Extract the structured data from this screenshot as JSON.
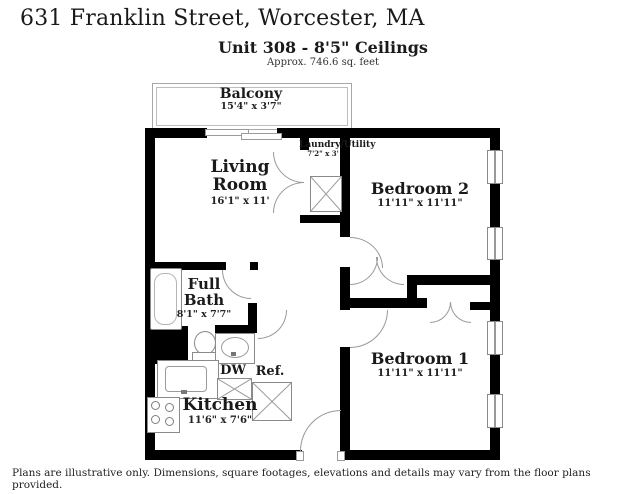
{
  "header": {
    "address": "631 Franklin Street, Worcester, MA",
    "unit_title": "Unit 308 - 8'5\" Ceilings",
    "unit_subtitle": "Approx. 746.6 sq. feet"
  },
  "rooms": {
    "balcony": {
      "name": "Balcony",
      "dims": "15'4\" x 3'7\""
    },
    "living": {
      "name": "Living Room",
      "dims": "16'1\" x 11'"
    },
    "laundry": {
      "name": "Laundry/Utility",
      "dims": "7'2\" x 3'"
    },
    "bedroom2": {
      "name": "Bedroom 2",
      "dims": "11'11\" x 11'11\""
    },
    "bath": {
      "name": "Full Bath",
      "dims": "8'1\" x 7'7\""
    },
    "kitchen": {
      "name": "Kitchen",
      "dims": "11'6\" x 7'6\""
    },
    "bedroom1": {
      "name": "Bedroom 1",
      "dims": "11'11\" x 11'11\""
    }
  },
  "appliances": {
    "dishwasher_label": "DW",
    "refrigerator_label": "Ref."
  },
  "footer": {
    "disclaimer": "Plans are illustrative only. Dimensions, square footages, elevations and details may vary from the floor plans provided."
  },
  "colors": {
    "wall": "#000000",
    "fixture_line": "#8a8a8a",
    "text": "#1a1a1a"
  }
}
